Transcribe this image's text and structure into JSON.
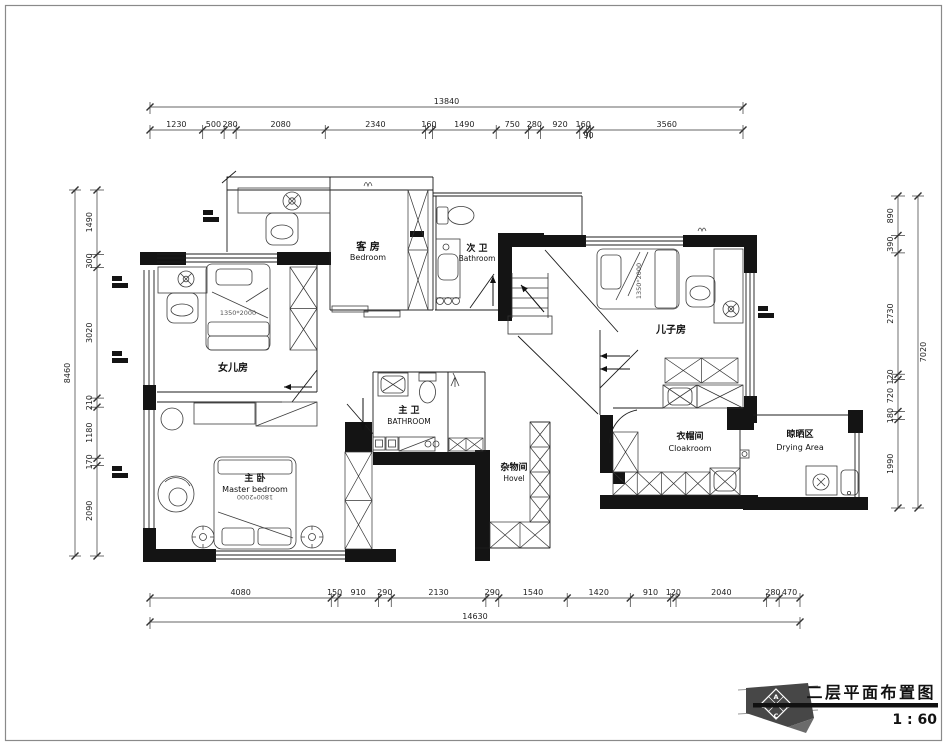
{
  "sheet": {
    "border_color": "#8a8a8a"
  },
  "title_block": {
    "title": "二层平面布置图",
    "scale_label": "1 : 60",
    "logo": {
      "top": "A",
      "left": "D",
      "right": "B",
      "bottom": "C"
    }
  },
  "rooms": {
    "guest": {
      "cn": "客 房",
      "en": "Bedroom"
    },
    "second_bath": {
      "cn": "次 卫",
      "en": "Bathroom"
    },
    "daughter": {
      "cn": "女儿房",
      "bed_size": "1350*2000"
    },
    "master": {
      "cn": "主 卧",
      "en": "Master bedroom",
      "bed_size": "1800*2000"
    },
    "master_bath": {
      "cn": "主 卫",
      "en": "BATHROOM"
    },
    "hovel": {
      "cn": "杂物间",
      "en": "Hovel"
    },
    "son": {
      "cn": "儿子房",
      "bed_size": "1350*2000"
    },
    "cloakroom": {
      "cn": "衣帽间",
      "en": "Cloakroom"
    },
    "drying": {
      "cn": "晾晒区",
      "en": "Drying Area"
    }
  },
  "dimensions": {
    "top": {
      "total": "13840",
      "segments": [
        "1230",
        "500",
        "280",
        "2080",
        "2340",
        "160",
        "1490",
        "750",
        "280",
        "920",
        "160",
        "90",
        "3560"
      ]
    },
    "bottom": {
      "total": "14630",
      "segments": [
        "4080",
        "150",
        "910",
        "290",
        "2130",
        "290",
        "1540",
        "1420",
        "910",
        "120",
        "2040",
        "280",
        "470"
      ]
    },
    "left": {
      "total": "8460",
      "segments": [
        "1490",
        "300",
        "3020",
        "210",
        "1180",
        "170",
        "2090"
      ]
    },
    "right": {
      "total": "7020",
      "segments": [
        "890",
        "390",
        "2730",
        "120",
        "720",
        "180",
        "1990"
      ]
    }
  }
}
